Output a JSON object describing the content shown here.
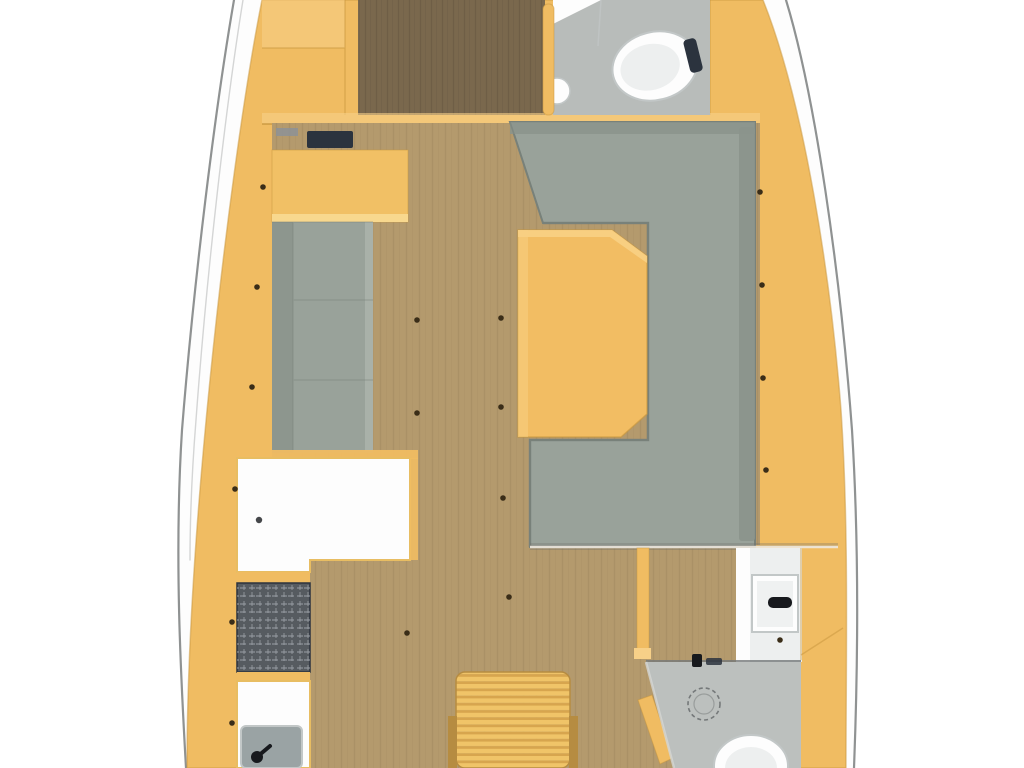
{
  "plan": {
    "vessel": "sailing-yacht-interior-floorplan",
    "orientation": "bow-at-top",
    "rooms": [
      {
        "name": "forward-cabin",
        "features": [
          "berth",
          "wood-sole",
          "bulkhead"
        ]
      },
      {
        "name": "forward-head",
        "features": [
          "toilet",
          "sink",
          "door"
        ]
      },
      {
        "name": "salon",
        "features": [
          "port-settee",
          "chart-desk",
          "instrument-panel",
          "u-shaped-sofa",
          "dining-table"
        ]
      },
      {
        "name": "galley",
        "features": [
          "counter",
          "stove",
          "sink",
          "faucet"
        ]
      },
      {
        "name": "companionway",
        "features": [
          "steps",
          "side-rails"
        ]
      },
      {
        "name": "aft-head",
        "features": [
          "sink",
          "faucet",
          "shower-drain",
          "toilet",
          "door"
        ]
      },
      {
        "name": "aft-cabin",
        "features": [
          "doorway",
          "wood-sole"
        ]
      }
    ]
  },
  "colors": {
    "page_bg": "#ffffff",
    "hull_fill": "#fdfdfd",
    "hull_line": "#8f9292",
    "hull_line_soft": "#b2b5b5",
    "interior_yellow": "#f0bc62",
    "yellow_light": "#f7d088",
    "yellow_seam": "#c8963e",
    "wood_floor": "#b49a6d",
    "wood_grain": "#8f7a50",
    "berth_wood": "#7a684d",
    "berth_grain": "#60523e",
    "sofa_gray": "#99a29a",
    "sofa_gray_dark": "#78817a",
    "sofa_back": "#8b948c",
    "settee_back": "#8d968e",
    "settee_front": "#a9b1a9",
    "table_yellow": "#f2bd63",
    "table_light": "#f8d084",
    "desk_yellow": "#f1c065",
    "desk_edge": "#f8d88e",
    "bath_floor": "#b8bcba",
    "bath_floor_aft": "#bcc0be",
    "bath_line": "#75797a",
    "fixture_white": "#fdfdfd",
    "fixture_shade": "#edefef",
    "fixture_stroke": "#c2c7c7",
    "stove_dark": "#565b60",
    "stove_line": "#9aa0a5",
    "sink_gray": "#9aa3a4",
    "dark_hardware": "#17191d",
    "instrument_dark": "#2b333e",
    "instrument_gray": "#8d9297",
    "stair_slat": "#f0c468",
    "stair_slat_dark": "#d7a54e",
    "stair_rail": "#b68c41",
    "screw": "#3a2d18",
    "shadow": "#6f6f6a",
    "counter_white": "#fdfdfd",
    "counter_trim": "#e8bd62"
  }
}
